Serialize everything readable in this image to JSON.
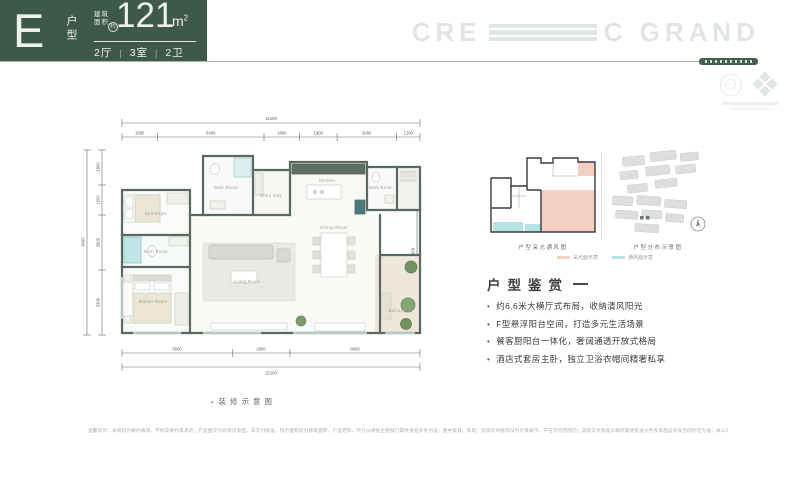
{
  "header": {
    "unit_letter": "E",
    "unit_type": "户型",
    "area_label_1": "建筑",
    "area_label_2": "面积",
    "area_approx": "约",
    "area_value": "121",
    "area_unit_base": "m",
    "area_unit_sup": "2",
    "spec_separator": "|",
    "spec_items": [
      "2厅",
      "3室",
      "2卫"
    ],
    "bg_color": "#3e5949"
  },
  "brand": {
    "logo_left": "CRE",
    "logo_right": "C GRAND",
    "logo_color": "#e1e6e2"
  },
  "floor_plan": {
    "dims_top_total": "15100",
    "dims_top": [
      "1800",
      "5400",
      "1800",
      "1900",
      "3000",
      "1200"
    ],
    "dims_bottom": [
      "5600",
      "2900",
      "6600"
    ],
    "dims_bottom_total": "15100",
    "dims_left_total": "9400",
    "dims_left": [
      "1800",
      "1500",
      "2800",
      "3300"
    ],
    "dims_right": [
      "2000",
      "4800",
      "1500"
    ],
    "room_labels": [
      "Bed Room",
      "Bath Room",
      "Master Room",
      "Bath Room",
      "Entry Way",
      "Kitchen",
      "Bath Room",
      "Living Room",
      "Dining Room",
      "Balcony"
    ],
    "wall_color": "#5c685f",
    "shower_color": "#c2e6e8",
    "counter_color": "#5e7063",
    "plant_color": "#7e9c6f",
    "balcony_floor": "#ede7da"
  },
  "panel": {
    "diagram1_caption": "户型采光通风图",
    "diagram2_caption": "户型分布示意图",
    "legend": [
      {
        "label": "采光面示意",
        "color": "#f4d0c2"
      },
      {
        "label": "通风面示意",
        "color": "#b5e4e8"
      }
    ],
    "appreciation_title": "户型鉴赏",
    "bullets": [
      "约6.6米大横厅式布局，收纳清风阳光",
      "F型悬浮阳台空间，打造多元生活场景",
      "餐客厨阳台一体化，奢阔通透开放式格局",
      "酒店式套房主卧，独立卫浴衣帽间精奢私享"
    ]
  },
  "footer": {
    "caption_marker": "▲",
    "caption": "装修示意图",
    "disclaimer": "温馨提示：本资料为要约邀请，不构成要约或承诺；户型图仅为装修示意图，非交付标准，所示面积均为建筑面积，户型结构、尺寸以规划主管部门最终批准文件为准；图中家具、家电、装饰及绿植等仅为示意展示，不在交付范围内；实际交付标准以政府最终批准文件及商品房买卖合同约定为准；本公司保留对宣传资料进行修改的权利，敬请留意最新资料。"
  }
}
